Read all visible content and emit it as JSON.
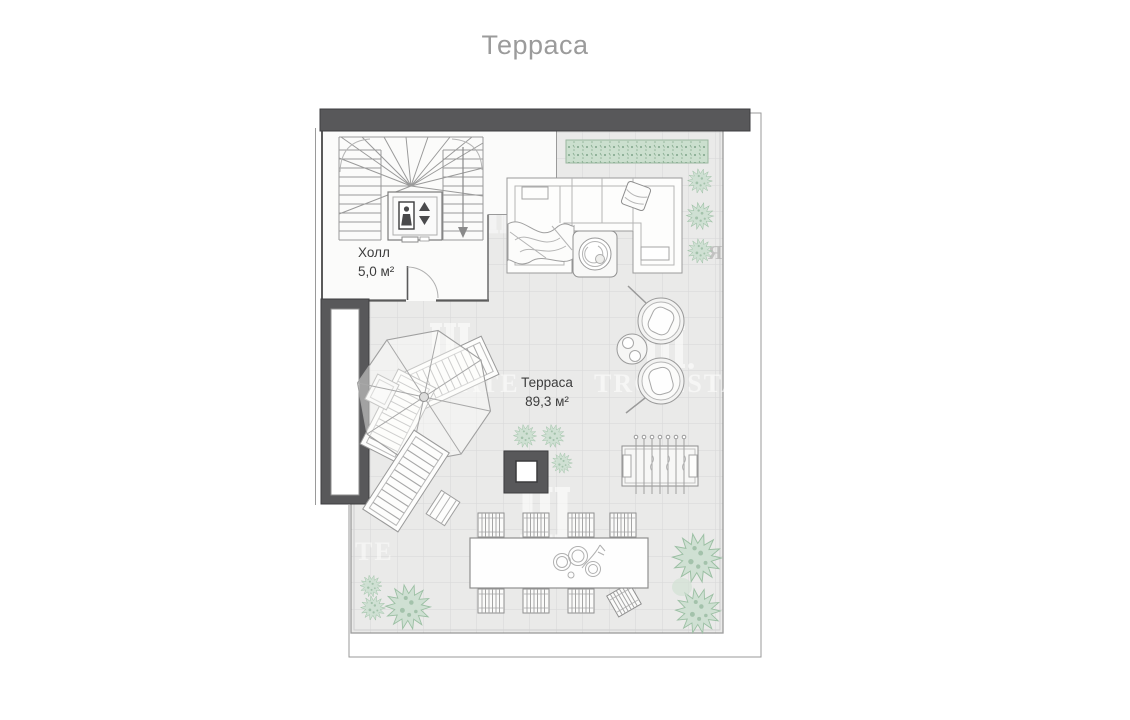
{
  "page": {
    "title": "Терраса",
    "title_color": "#9b9b9b",
    "background": "#ffffff"
  },
  "plan": {
    "rooms": [
      {
        "name": "Холл",
        "area": "5,0 м²"
      },
      {
        "name": "Терраса",
        "area": "89,3 м²"
      }
    ],
    "colors": {
      "wall_dark": "#58585a",
      "terrace_floor": "#eaeae9",
      "hall_floor": "#fbfbfa",
      "furniture_line": "#9a9a9a",
      "plant_fill": "#cfe0d3",
      "hedge_fill": "#cbdfce"
    },
    "icons": {
      "elevator_person": "person-silhouette",
      "elevator_up_arrow": "filled-up-triangle",
      "elevator_down_arrow": "filled-down-triangle",
      "stair_direction_arrow": "down-arrow"
    },
    "watermark": {
      "logo": "three-pillars",
      "fragments": {
        "left": "ATE",
        "tro": "TRO",
        "esta": "ESTA",
        "corner": "TE",
        "edge": "Я"
      }
    }
  }
}
